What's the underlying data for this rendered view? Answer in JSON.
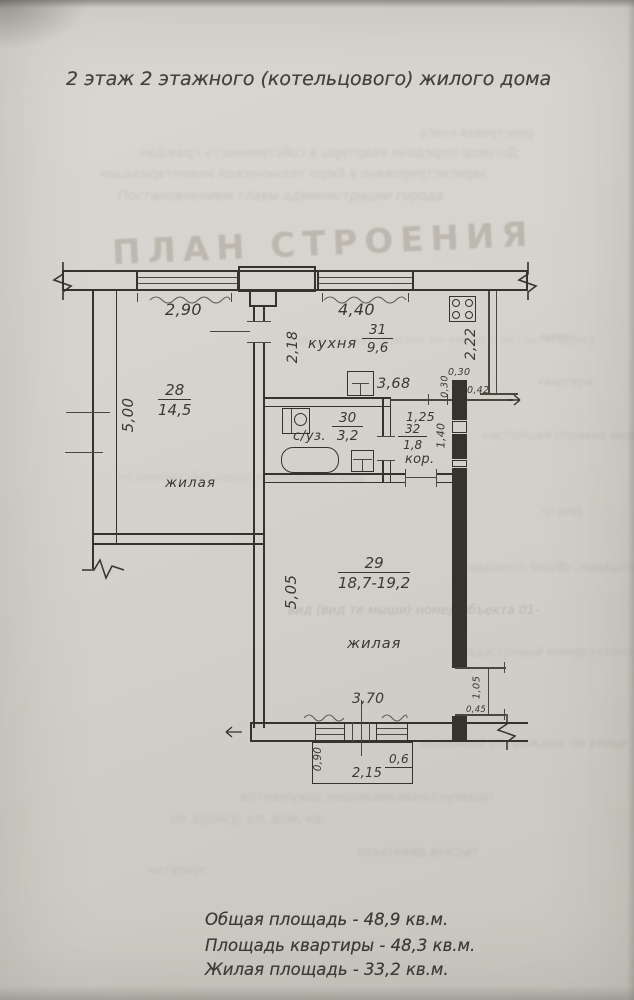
{
  "page": {
    "title": "2 этаж 2 этажного (котельцового) жилого дома",
    "watermark": "ПЛАН СТРОЕНИЯ"
  },
  "rooms": {
    "room28": {
      "number": "28",
      "area": "14,5",
      "label": "жилая"
    },
    "kitchen": {
      "label": "кухня",
      "number": "31",
      "area": "9,6"
    },
    "bathroom": {
      "label": "с/уз.",
      "number": "30",
      "area": "3,2"
    },
    "corridor": {
      "label": "кор.",
      "number": "32",
      "area": "1,8"
    },
    "room29": {
      "number": "29",
      "area": "18,7-19,2",
      "label": "жилая"
    }
  },
  "dimensions": {
    "top_window_left": "2,90",
    "top_window_right": "4,40",
    "partition_height": "2,18",
    "kitchen_side": "2,22",
    "room28_side": "5,00",
    "kitchen_depth": "3,68",
    "pier_width": "0,30",
    "pier_height": "0,30",
    "pier_offset": "0,42",
    "corridor_width": "1,25",
    "corridor_depth": "1,40",
    "room29_side": "5,05",
    "room29_width": "3,70",
    "shaft_height": "1,05",
    "shaft_width": "0,45",
    "balcony_depth": "0,90",
    "balcony_width": "2,15",
    "balcony_door": "0,6"
  },
  "summary": {
    "total": "Общая площадь - 48,9 кв.м.",
    "apartment": "Площадь квартиры - 48,3 кв.м.",
    "living": "Жилая площадь - 33,2 кв.м."
  },
  "bleedthrough": {
    "lines": [
      "Договор передачи квартиры в собственность граждан",
      "зарегистрировано в бюро технической инвентаризации",
      "Постановлением главы администрации города",
      "реестровая книга",
      "свидетельство о праве на наследство по закону",
      "настоящая справка выдана",
      "для оформления права собственности",
      "вид (вид те мыши) номер объекта 01-",
      "кадастровый номер установлен",
      "общей площадью, общей площади",
      "выданный от граждан, по улице",
      "правоустанавливающих документов",
      "по адресу: ул. дом, кв.",
      "тысяча девятьсот",
      "нотариус",
      "семья",
      "квартира",
      "реестр"
    ]
  }
}
